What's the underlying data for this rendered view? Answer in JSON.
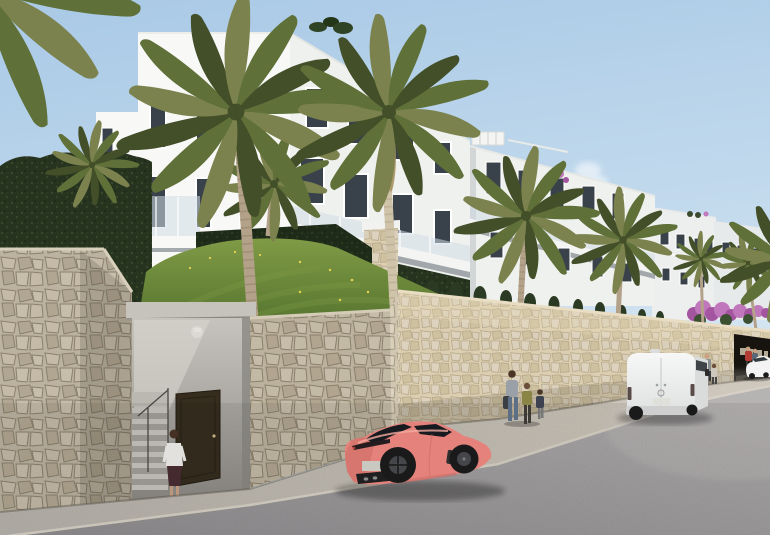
{
  "meta": {
    "title": "Architectural rendering of a modern white apartment complex above a stone retaining wall, street view",
    "scene_type": "3D exterior render",
    "time_of_day": "daytime, clear blue sky"
  },
  "colors": {
    "sky_top": "#a9c9e6",
    "sky_mid": "#c3daed",
    "sky_horizon": "#e3eef5",
    "building_white": "#f8f9f7",
    "building_side": "#eff1ef",
    "building_far": "#ecefee",
    "building_far2": "#e7eaea",
    "building_gap": "#c6cbcd",
    "window_dark": "#39424a",
    "glass_rail": "#cfdde6",
    "slab_shadow": "#8e959a",
    "hedge_dark": "#26331f",
    "hedge_mid": "#3a4a2d",
    "grass": "#51702c",
    "grass_light": "#809b46",
    "flower_yellow": "#e6d44f",
    "palm_green": "#5f7038",
    "palm_olive": "#7c824d",
    "palm_olive2": "#8a8f55",
    "palm_dark": "#434f28",
    "palm_dead": "#a5905e",
    "trunk": "#b3a289",
    "trunk_ring": "#94836c",
    "trunk_pale": "#cfc3aa",
    "trunk_pale_ring": "#b2a58c",
    "stone_fill": "#cfc5b0",
    "stone_a": "#d9cfba",
    "stone_b": "#c3b7a0",
    "stone_c": "#dcd2be",
    "stone_mortar": "#968b76",
    "stone_sun": "#dccfb1",
    "stone_sun_b": "#cec19f",
    "concrete": "#c6c3bd",
    "concrete_dark": "#8d8a85",
    "door_brown": "#362d1f",
    "road": "#8e8c8e",
    "road_far": "#b0aeae",
    "sidewalk": "#b7b3ac",
    "sidewalk_sun": "#cfc8bb",
    "curb_light": "#d8d2c6",
    "car_pink": "#e5827b",
    "car_pink_light": "#f4aba1",
    "car_pink_dark": "#c76a64",
    "car_glass": "#171b1f",
    "wheel_dark": "#1a1a1a",
    "rim_gray": "#45464a",
    "plate": "#c9c9c2",
    "van_white": "#f2f3f2",
    "van_shade": "#dadcdc",
    "van_bumper": "#cfcfcf",
    "van_light": "#5a4a48",
    "bougainvillea": "#a455a0",
    "bougainvillea_light": "#c077bb",
    "bougainvillea_green": "#3a5030",
    "skin": "#c9a183",
    "hair_dark": "#4a3526",
    "hair_brown": "#6b4f3a",
    "blouse_white": "#f2f1ee",
    "skirt_dark": "#4a2e33",
    "mom_top": "#9aa0a8",
    "jeans": "#5d6f85",
    "bag_dark": "#3a3f46",
    "kid_olive": "#8a8544",
    "kid_navy": "#3c4250",
    "jacket_gray": "#8a8d90",
    "shirt_light": "#cfc8bf",
    "jacket_red": "#b33c34",
    "jacket_blue": "#5b6877",
    "garage_dark": "#17140f",
    "sign_light": "#cfc6ae"
  },
  "scene": {
    "setting": "Street-level view of a modern white Mediterranean apartment complex on a hillside behind a cream rubble-stone retaining wall, with palm trees, a sunlit lawn and parked vehicles along an empty asphalt road",
    "sky": {
      "condition": "clear blue",
      "cloud": "one small white wisp right of the tall centre palm"
    },
    "buildings": [
      {
        "id": "main-building",
        "style": "white flat-roof apartments, 3 storeys",
        "features": [
          "dark recessed windows",
          "glass balcony balustrades",
          "rooftop shrubs",
          "ivy-clad base"
        ]
      },
      {
        "id": "mid-building",
        "style": "white apartments receding to the right",
        "features": [
          "continuous balcony band with glass railing",
          "rooftop pergola",
          "pink bougainvillea accent"
        ]
      },
      {
        "id": "distant-buildings",
        "count": 2,
        "features": [
          "roof terraces with plants",
          "small dark windows"
        ]
      }
    ],
    "vegetation": {
      "palms_large": 4,
      "palms_small": 5,
      "hedges": [
        "tall dark hedge at left",
        "ivy wall mid-slope",
        "cypress row along the street wall"
      ],
      "grass_slope": "sunlit lawn with small yellow wildflowers",
      "bougainvillea": "purple, at the far right end of the wall"
    },
    "street": {
      "stone_wall": "cream rubble masonry retaining wall with pedestrian stair entrance and dark brown door",
      "garage": "dark entrance opening at far right with small illegible light lettering",
      "sidewalk": "light concrete strip",
      "road": "empty asphalt foreground"
    },
    "vehicles": [
      {
        "id": "sports-car",
        "type": "coupe",
        "color_name": "coral pink",
        "view": "rear three-quarter",
        "position": "parked at the curb, centre-left foreground"
      },
      {
        "id": "cargo-van",
        "type": "panel van",
        "color_name": "white",
        "view": "rear three-quarter",
        "position": "parked further up the street"
      },
      {
        "id": "sedan",
        "type": "sedan",
        "color_name": "white",
        "position": "distant, far right"
      }
    ],
    "people": [
      {
        "id": "woman-stairs",
        "desc": "woman in white blouse and dark skirt walking toward the stair entrance"
      },
      {
        "id": "adult-with-children",
        "desc": "adult with shoulder bag and two children walking on the sidewalk"
      },
      {
        "id": "man-and-child",
        "desc": "man and child walking near the parked van"
      },
      {
        "id": "two-pedestrians-far",
        "desc": "two distant figures by the far entrance, one wearing red"
      }
    ]
  }
}
